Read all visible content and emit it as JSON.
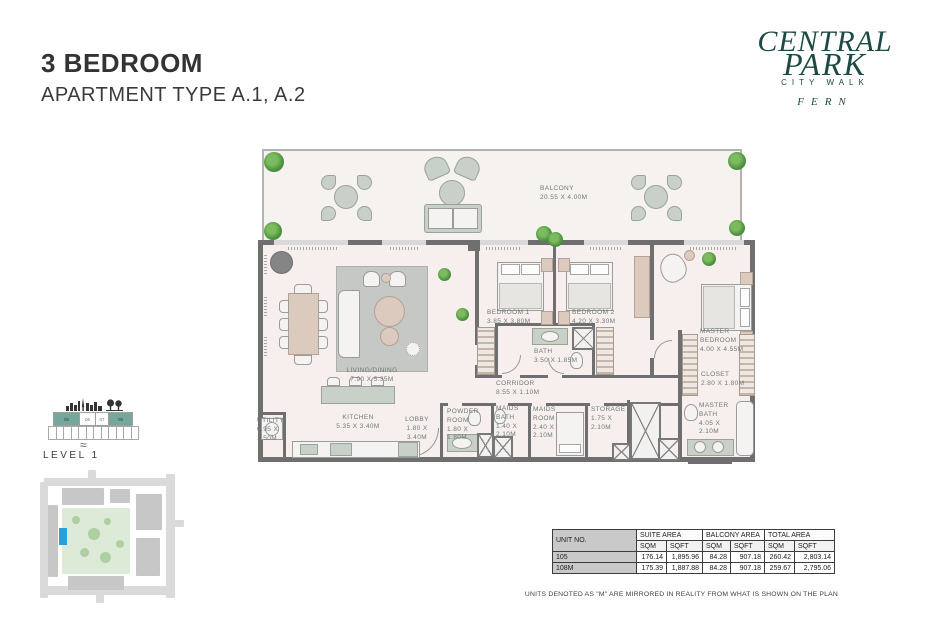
{
  "page": {
    "title": "3 BEDROOM",
    "subtitle": "APARTMENT TYPE A.1, A.2"
  },
  "logo": {
    "line1": "CENTRAL",
    "line2": "PARK",
    "line3": "CITY WALK",
    "line4": "FERN",
    "color": "#1d4a44"
  },
  "floorplan": {
    "rooms": [
      {
        "name": "BALCONY",
        "dims": "20.55 X 4.00M"
      },
      {
        "name": "LIVING/DINING",
        "dims": "7.90 X 5.35M"
      },
      {
        "name": "KITCHEN",
        "dims": "5.35 X 3.40M"
      },
      {
        "name": "UTILITY",
        "dims": "0.95 X 1.50M"
      },
      {
        "name": "LOBBY",
        "dims": "1.80 X 3.40M"
      },
      {
        "name": "POWDER ROOM",
        "dims": "1.80 X 1.80M"
      },
      {
        "name": "MAIDS BATH",
        "dims": "1.40 X 2.10M"
      },
      {
        "name": "MAIDS ROOM",
        "dims": "2.40 X 2.10M"
      },
      {
        "name": "STORAGE",
        "dims": "1.75 X 2.10M"
      },
      {
        "name": "CORRIDOR",
        "dims": "8.55 X 1.10M"
      },
      {
        "name": "BATH",
        "dims": "3.50 X 1.85M"
      },
      {
        "name": "BEDROOM 1",
        "dims": "3.85 X 3.80M"
      },
      {
        "name": "BEDROOM 2",
        "dims": "4.20 X 3.30M"
      },
      {
        "name": "MASTER BEDROOM",
        "dims": "4.00 X 4.55M"
      },
      {
        "name": "CLOSET",
        "dims": "2.80 X 1.80M"
      },
      {
        "name": "MASTER BATH",
        "dims": "4.05 X 2.10M"
      }
    ]
  },
  "level_indicator": {
    "label": "LEVEL 1",
    "cells": [
      "05",
      "06",
      "07",
      "08"
    ],
    "highlighted_cells": [
      "05",
      "08"
    ],
    "highlight_color": "#76a79d"
  },
  "site_map": {
    "highlight_color": "#2a9fd8",
    "park_color": "#dcead7"
  },
  "table": {
    "unit_header": "UNIT NO.",
    "groups": [
      "SUITE AREA",
      "BALCONY AREA",
      "TOTAL AREA"
    ],
    "subheaders": [
      "SQM",
      "SQFT",
      "SQM",
      "SQFT",
      "SQM",
      "SQFT"
    ],
    "rows": [
      {
        "unit": "105",
        "values": [
          "176.14",
          "1,895.96",
          "84.28",
          "907.18",
          "260.42",
          "2,803.14"
        ]
      },
      {
        "unit": "108M",
        "values": [
          "175.39",
          "1,887.88",
          "84.28",
          "907.18",
          "259.67",
          "2,795.06"
        ]
      }
    ]
  },
  "footnote": "UNITS DENOTED AS \"M\" ARE MIRRORED IN REALITY FROM WHAT IS SHOWN ON THE PLAN"
}
